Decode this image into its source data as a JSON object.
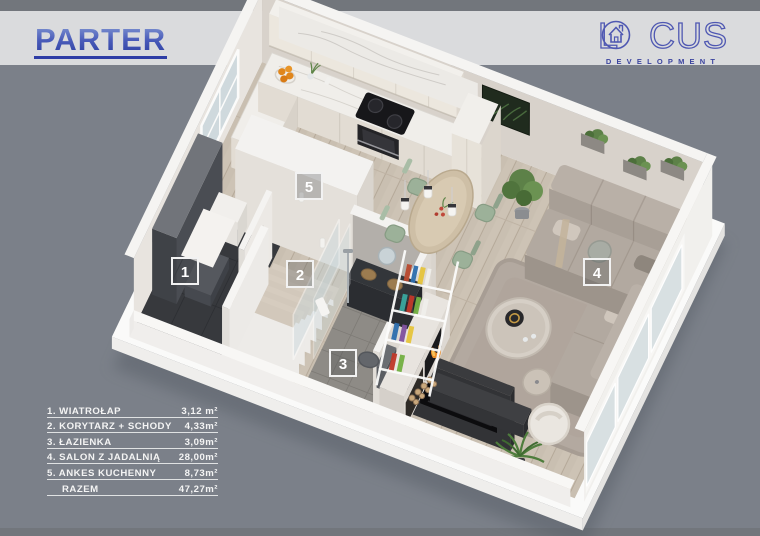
{
  "header": {
    "title": "PARTER"
  },
  "logo": {
    "brand_prefix": "L",
    "brand_suffix": "CUS",
    "subtitle": "DEVELOPMENT",
    "o_icon": "house-in-circle-icon",
    "color": "#4f58b2"
  },
  "legend": {
    "rows": [
      {
        "label": "1. WIATROŁAP",
        "value": "3,12 m²"
      },
      {
        "label": "2. KORYTARZ + SCHODY",
        "value": "4,33m²"
      },
      {
        "label": "3. ŁAZIENKA",
        "value": "3,09m²"
      },
      {
        "label": "4. SALON Z JADALNIĄ",
        "value": "28,00m²"
      },
      {
        "label": "5. ANKES KUCHENNY",
        "value": "8,73m²"
      },
      {
        "label": "RAZEM",
        "value": "47,27m²"
      }
    ]
  },
  "markers": [
    {
      "number": "1",
      "room": "wiatrołap"
    },
    {
      "number": "2",
      "room": "korytarz + schody"
    },
    {
      "number": "3",
      "room": "łazienka"
    },
    {
      "number": "4",
      "room": "salon z jadalnią"
    },
    {
      "number": "5",
      "room": "ankes kuchenny"
    }
  ],
  "colors": {
    "background": "#7b8089",
    "header_band": "#dadbdd",
    "strip": "#72767c",
    "title_blue": "#2e3da5",
    "logo_blue": "#4f58b2",
    "legend_text": "#f4f4f4"
  }
}
